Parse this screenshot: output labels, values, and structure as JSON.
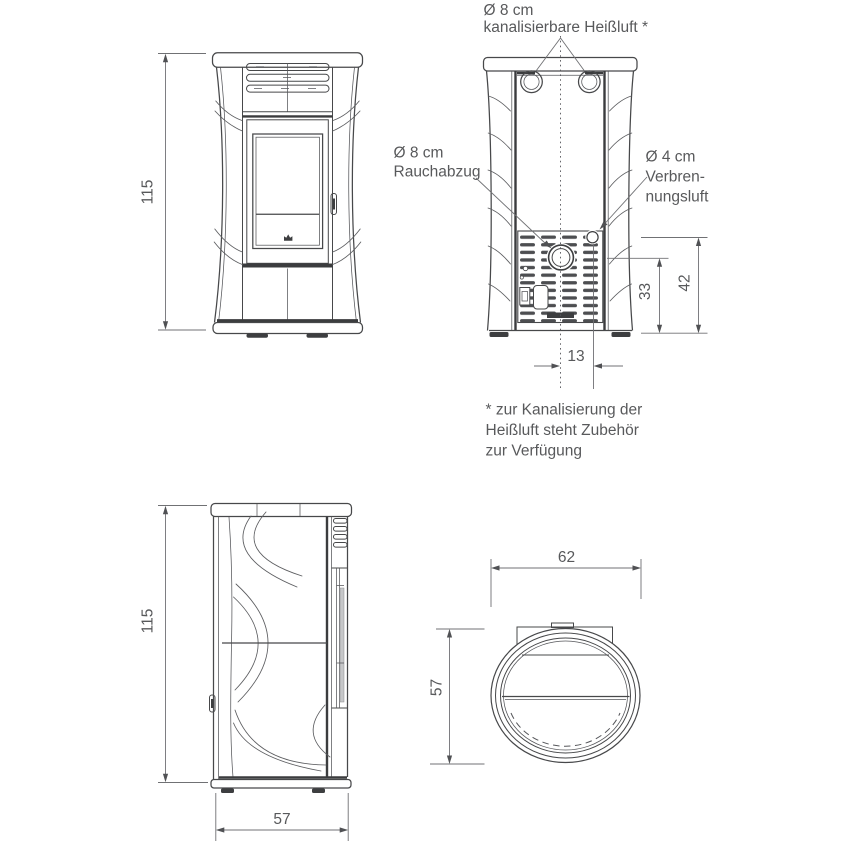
{
  "document": {
    "type": "technical-dimension-drawing",
    "subject": "Pelletofen Maßzeichnung",
    "unit": "cm"
  },
  "palette": {
    "background": "#ffffff",
    "line": "#47484a",
    "line_heavy": "#3b3c3e",
    "dimension_line": "#707174",
    "text": "#58595b"
  },
  "views": {
    "front": {
      "height": "115"
    },
    "back": {
      "duct_size": "Ø 8 cm",
      "duct_name": "kanalisierbare Heißluft *",
      "flue_size": "Ø 8 cm",
      "flue_name": "Rauchabzug",
      "air_size": "Ø 4 cm",
      "air_name_line1": "Verbren-",
      "air_name_line2": "nungsluft",
      "flue_center_height": "33",
      "air_center_height": "42",
      "air_center_offset": "13"
    },
    "side": {
      "height": "115",
      "depth": "57"
    },
    "top": {
      "width": "62",
      "depth": "57"
    }
  },
  "footnote": {
    "line1": "* zur Kanalisierung der",
    "line2": "Heißluft steht Zubehör",
    "line3": "zur Verfügung"
  }
}
